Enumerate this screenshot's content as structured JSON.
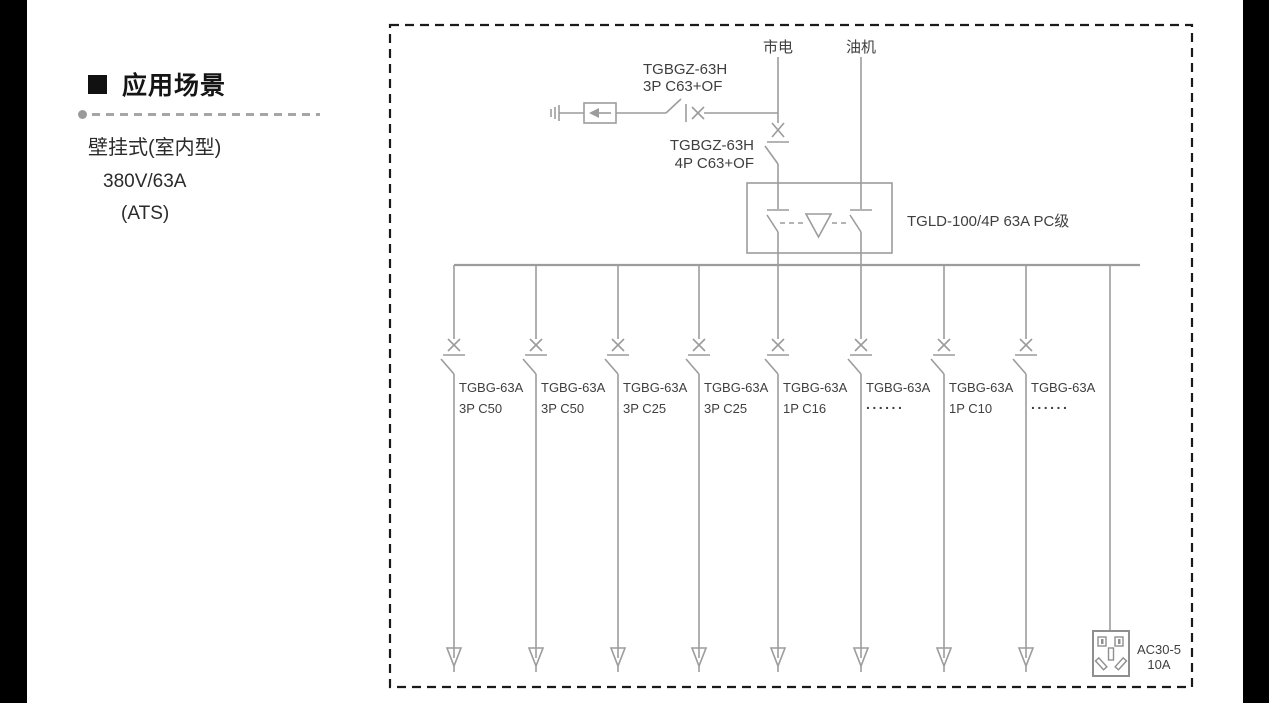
{
  "left_panel": {
    "title": "应用场景",
    "subtitle_lines": [
      "壁挂式(室内型)",
      "380V/63A",
      "(ATS)"
    ]
  },
  "diagram": {
    "mains_label": "市电",
    "generator_label": "油机",
    "spd_branch_breaker": {
      "model": "TGBGZ-63H",
      "spec": "3P C63+OF"
    },
    "incoming_breaker": {
      "model": "TGBGZ-63H",
      "spec": "4P C63+OF"
    },
    "ats_label": "TGLD-100/4P 63A PC级",
    "branches": [
      {
        "model": "TGBG-63A",
        "spec": "3P C50"
      },
      {
        "model": "TGBG-63A",
        "spec": "3P C50"
      },
      {
        "model": "TGBG-63A",
        "spec": "3P C25"
      },
      {
        "model": "TGBG-63A",
        "spec": "3P C25"
      },
      {
        "model": "TGBG-63A",
        "spec": "1P C16"
      },
      {
        "model": "TGBG-63A",
        "spec": "......"
      },
      {
        "model": "TGBG-63A",
        "spec": "1P C10"
      },
      {
        "model": "TGBG-63A",
        "spec": "......"
      }
    ],
    "socket": {
      "model": "AC30-5",
      "rating": "10A"
    }
  },
  "colors": {
    "line": "#9c9c9c",
    "text": "#3f3f3f",
    "border": "#1a1a1a"
  }
}
